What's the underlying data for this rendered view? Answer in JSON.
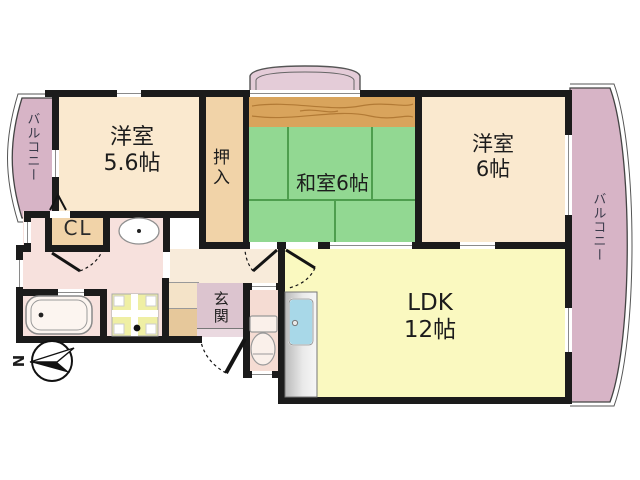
{
  "floor_plan": {
    "type": "japanese-apartment-madori",
    "rooms": {
      "western1": {
        "label": "洋室",
        "size": "5.6帖"
      },
      "oshiire": {
        "label": "押入"
      },
      "washitsu": {
        "label": "和室6帖"
      },
      "western2": {
        "label": "洋室",
        "size": "6帖"
      },
      "ldk": {
        "label": "LDK",
        "size": "12帖"
      },
      "cl": {
        "label": "CL"
      },
      "genkan": {
        "label": "玄関"
      },
      "balcony_left": {
        "label": "バルコニー"
      },
      "balcony_right": {
        "label": "バルコニー"
      }
    },
    "compass": {
      "north": "N"
    },
    "fixtures": [
      "bathtub",
      "washbasin",
      "washing-machine-pan",
      "toilet",
      "kitchen-sink",
      "bay-window",
      "shoe-cabinet"
    ],
    "colors": {
      "wall": "#1b1b1b",
      "western_room": "#FAE9CF",
      "ldk": "#FAF9C0",
      "tatami": "#92D892",
      "tatami_line": "#4E9E4E",
      "wood_floor": "#D9A45C",
      "closet_tan": "#F1D3A8",
      "balcony_pink": "#D7B4C6",
      "bay_window_pink": "#E4CCD8",
      "washroom_pink": "#F7E1DD",
      "genkan_lavender": "#DCC4CF",
      "hallway_cream": "#F8EBDA",
      "sink_blue": "#A8D8E8",
      "wash_pan_yellow": "#EFEFA4"
    }
  }
}
